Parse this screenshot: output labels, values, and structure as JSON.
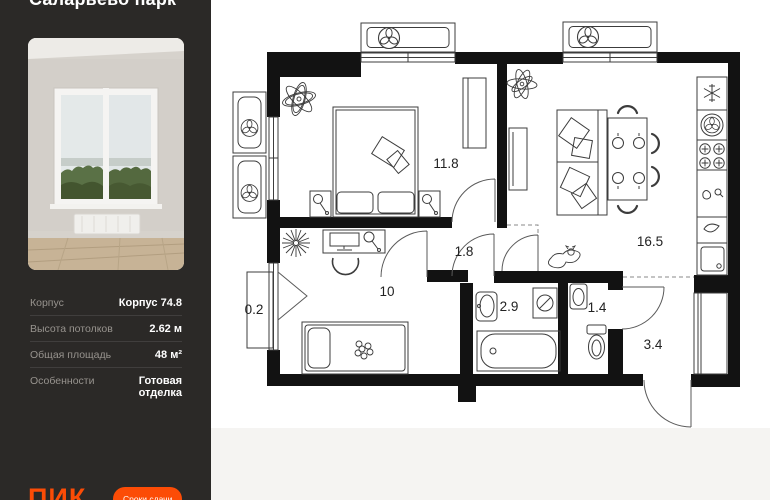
{
  "app": {
    "accent": "#fc4c06",
    "panel_bg": "#2b2927",
    "page_bg": "#f5f4f2"
  },
  "sidebar": {
    "title": "Саларьево парк",
    "details": [
      {
        "label": "Корпус",
        "value": "Корпус 74.8"
      },
      {
        "label": "Высота потолков",
        "value": "2.62 м"
      },
      {
        "label": "Общая площадь",
        "value": "48 м²"
      },
      {
        "label": "Особенности",
        "value": "Готовая отделка"
      }
    ],
    "brand": "ПИК",
    "cta_label": "Сроки сдачи"
  },
  "floorplan": {
    "rooms": [
      {
        "name": "bedroom",
        "area": "11.8"
      },
      {
        "name": "hallway",
        "area": "1.8"
      },
      {
        "name": "kitchen-living",
        "area": "16.5"
      },
      {
        "name": "room",
        "area": "10"
      },
      {
        "name": "balcony",
        "area": "0.2"
      },
      {
        "name": "bathroom",
        "area": "2.9"
      },
      {
        "name": "wc",
        "area": "1.4"
      },
      {
        "name": "entry-hall",
        "area": "3.4"
      }
    ]
  }
}
